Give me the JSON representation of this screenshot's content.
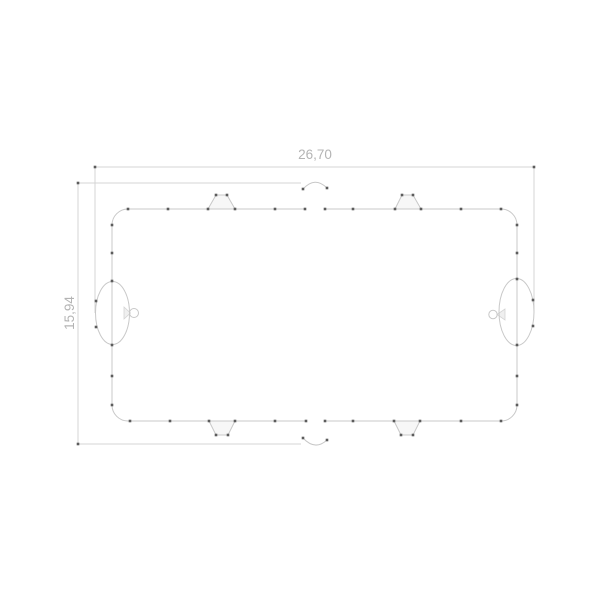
{
  "drawing": {
    "kind": "cad-2d-sketch",
    "description": "Top view technical drawing of a rounded rectangular part with four trapezoidal tabs on the long edges, elliptical bosses with small pin circles on the short sides, and shallow arc notches at the centers of the long edges",
    "dimensions": {
      "width_label": "26,70",
      "height_label": "15,94"
    },
    "colors": {
      "bg": "#ffffff",
      "line": "#c8c8c8",
      "dim": "#d4d4d4",
      "label": "#b4b4b4",
      "dot": "#5c5c5c",
      "tabfill": "#f7f7f7",
      "neckfill": "#efefef"
    },
    "vertex_dots": [
      [
        128,
        209
      ],
      [
        168,
        209
      ],
      [
        208,
        209
      ],
      [
        235,
        209
      ],
      [
        275,
        209
      ],
      [
        305,
        209
      ],
      [
        325,
        209
      ],
      [
        353,
        209
      ],
      [
        395,
        209
      ],
      [
        421,
        209
      ],
      [
        461,
        209
      ],
      [
        501,
        209
      ],
      [
        216,
        195
      ],
      [
        227,
        195
      ],
      [
        402,
        195
      ],
      [
        413,
        195
      ],
      [
        130,
        421
      ],
      [
        170,
        421
      ],
      [
        209,
        421
      ],
      [
        235,
        421
      ],
      [
        275,
        421
      ],
      [
        306,
        421
      ],
      [
        325,
        421
      ],
      [
        353,
        421
      ],
      [
        394,
        421
      ],
      [
        420,
        421
      ],
      [
        461,
        421
      ],
      [
        501,
        421
      ],
      [
        216,
        435
      ],
      [
        228,
        435
      ],
      [
        401,
        435
      ],
      [
        413,
        435
      ],
      [
        112,
        225
      ],
      [
        112,
        253
      ],
      [
        112,
        281
      ],
      [
        112,
        345
      ],
      [
        112,
        376
      ],
      [
        112,
        405
      ],
      [
        517,
        225
      ],
      [
        517,
        253
      ],
      [
        517,
        279
      ],
      [
        517,
        345
      ],
      [
        517,
        376
      ],
      [
        517,
        405
      ],
      [
        96,
        301
      ],
      [
        96,
        327
      ],
      [
        533,
        300
      ],
      [
        533,
        326
      ],
      [
        303,
        189
      ],
      [
        327,
        188
      ],
      [
        303,
        438
      ],
      [
        327,
        440
      ],
      [
        95,
        167
      ],
      [
        534,
        167
      ],
      [
        78,
        183
      ],
      [
        78,
        444
      ]
    ]
  }
}
